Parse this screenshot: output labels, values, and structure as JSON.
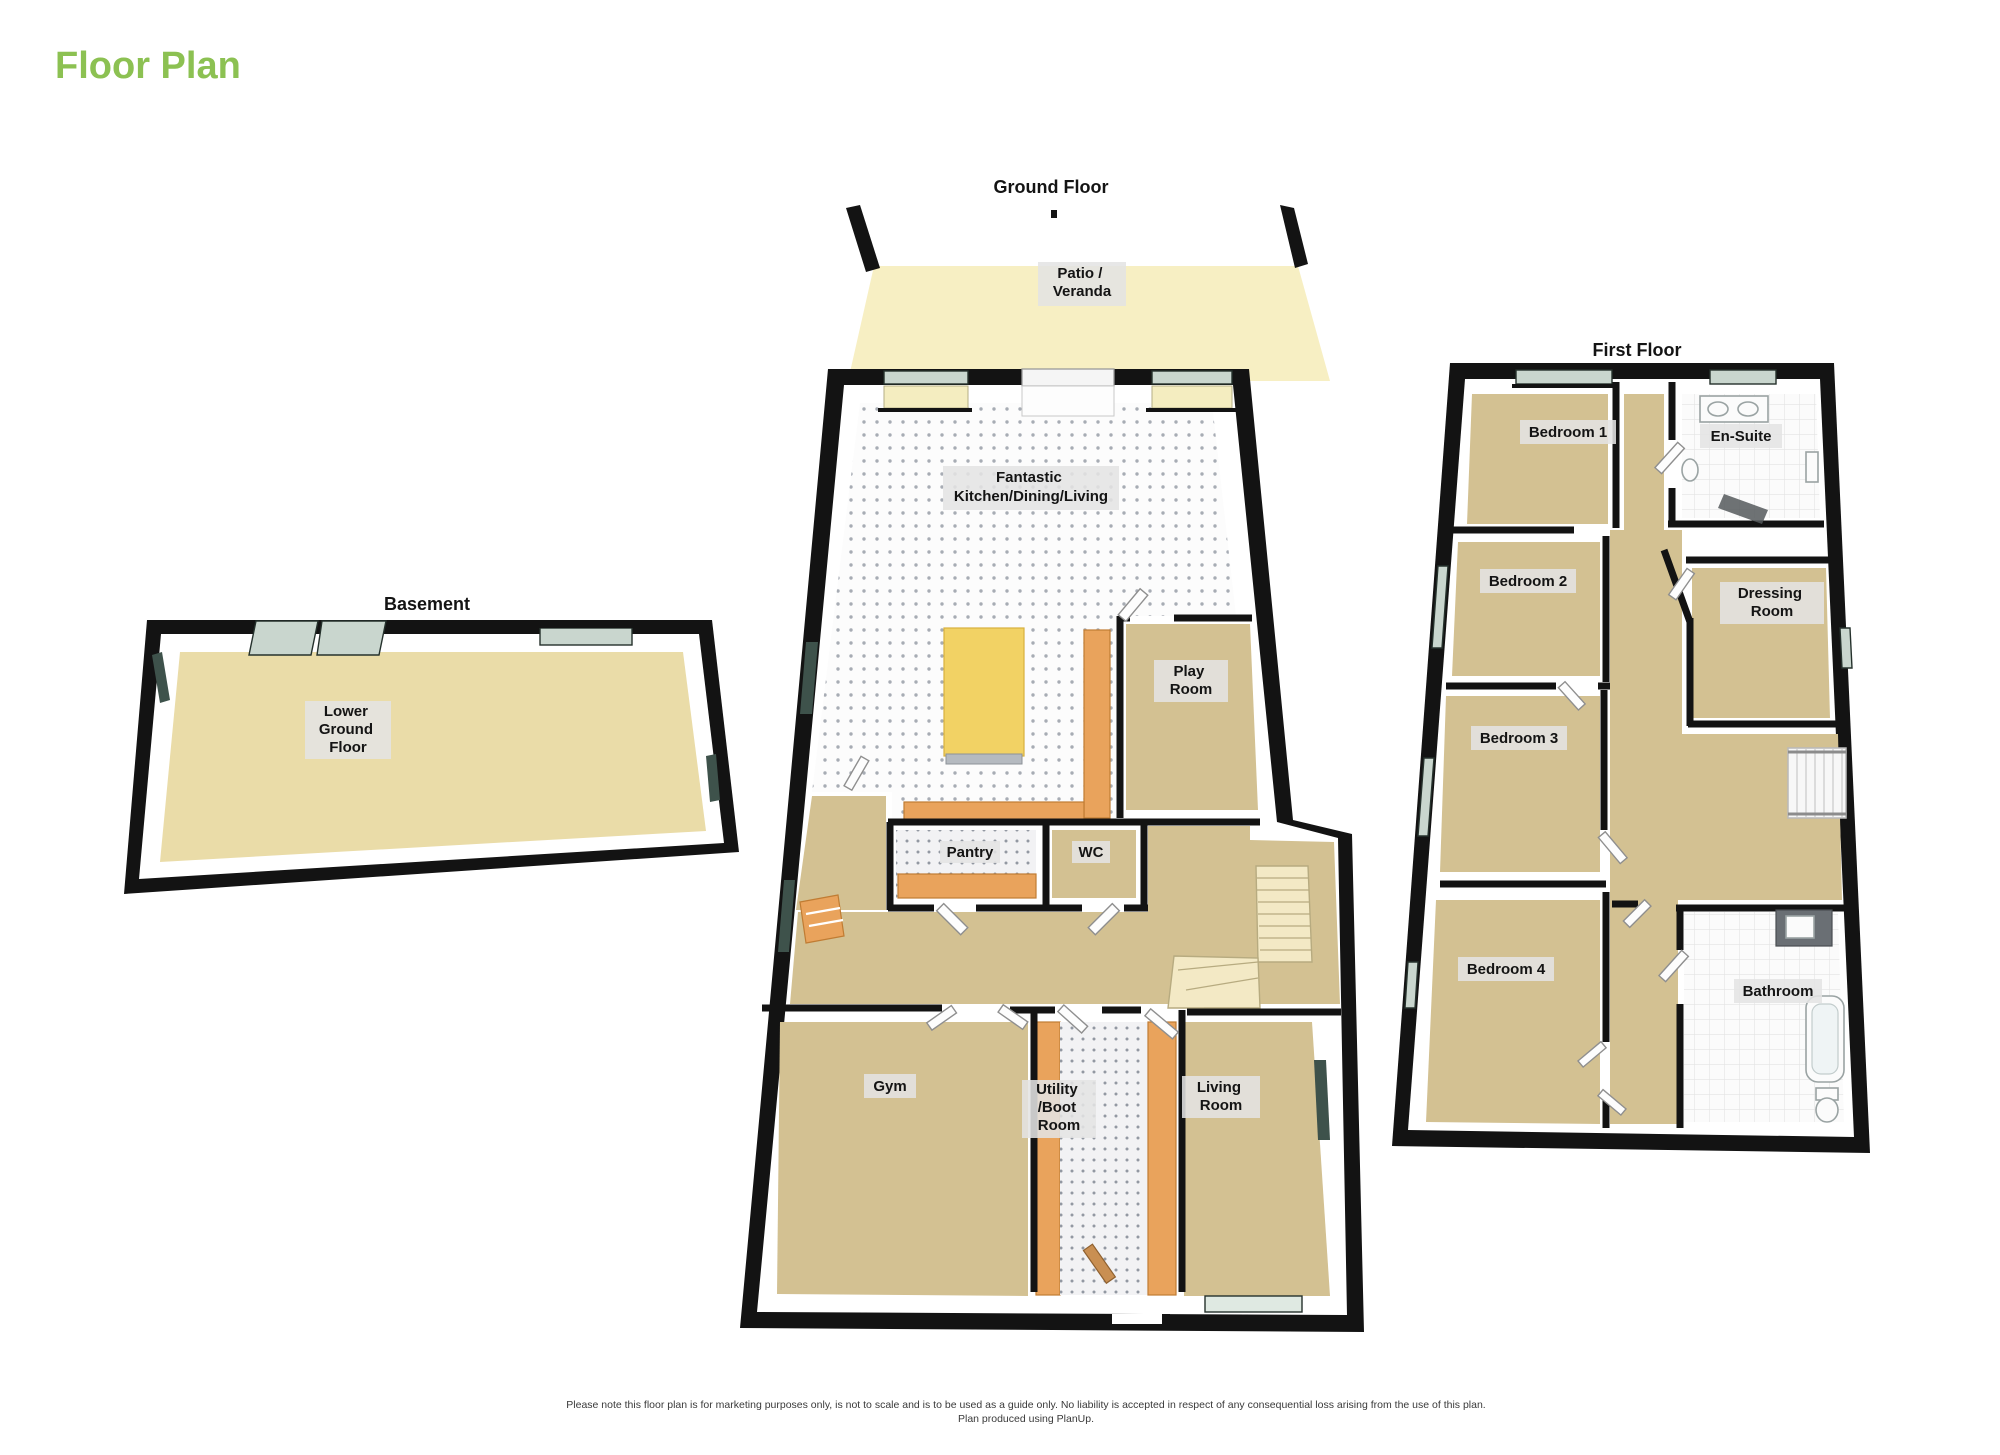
{
  "page": {
    "title": "Floor Plan"
  },
  "colors": {
    "title_green": "#8CC152",
    "wall": "#131313",
    "text": "#141414",
    "footer_text": "#3A3A3A",
    "chip_bg": "#E4E4E4",
    "floor_tan": "#D3C192",
    "floor_basement": "#EADCA8",
    "floor_patio": "#F7EFC3",
    "counter_orange": "#E9A35C",
    "island_yellow": "#F2D264",
    "glass_light": "#C9D6CE",
    "glass_dark": "#3E524B",
    "stair_cream": "#F3E9C5"
  },
  "floors": {
    "basement": {
      "title": "Basement",
      "rooms": {
        "lower_ground": {
          "lines": [
            "Lower",
            "Ground",
            "Floor"
          ]
        }
      }
    },
    "ground": {
      "title": "Ground Floor",
      "rooms": {
        "patio": {
          "lines": [
            "Patio /",
            "Veranda"
          ]
        },
        "kitchen": {
          "lines": [
            "Fantastic",
            "Kitchen/Dining/Living"
          ]
        },
        "play": {
          "lines": [
            "Play",
            "Room"
          ]
        },
        "pantry": {
          "lines": [
            "Pantry"
          ]
        },
        "wc": {
          "lines": [
            "WC"
          ]
        },
        "gym": {
          "lines": [
            "Gym"
          ]
        },
        "utility": {
          "lines": [
            "Utility",
            "/Boot",
            "Room"
          ]
        },
        "living": {
          "lines": [
            "Living",
            "Room"
          ]
        }
      }
    },
    "first": {
      "title": "First Floor",
      "rooms": {
        "bedroom1": {
          "lines": [
            "Bedroom 1"
          ]
        },
        "ensuite": {
          "lines": [
            "En-Suite"
          ]
        },
        "bedroom2": {
          "lines": [
            "Bedroom 2"
          ]
        },
        "dressing": {
          "lines": [
            "Dressing",
            "Room"
          ]
        },
        "bedroom3": {
          "lines": [
            "Bedroom 3"
          ]
        },
        "bedroom4": {
          "lines": [
            "Bedroom 4"
          ]
        },
        "bathroom": {
          "lines": [
            "Bathroom"
          ]
        }
      }
    }
  },
  "footer": {
    "line1": "Please note this floor plan is for marketing purposes only, is not to scale and is to be used as a guide only.  No liability is accepted in respect of any consequential loss arising from the use of this plan.",
    "line2": "Plan produced using PlanUp."
  }
}
